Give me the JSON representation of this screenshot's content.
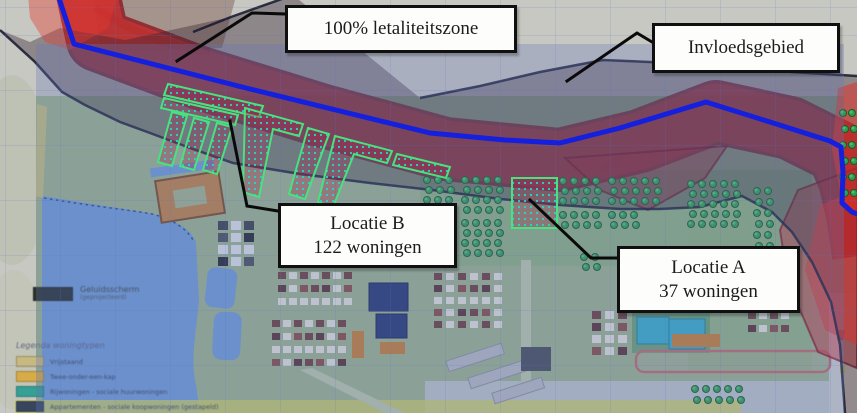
{
  "annotations": {
    "letaliteitszone": "100% letaliteitszone",
    "invloedsgebied": "Invloedsgebied",
    "locatie_b_title": "Locatie B",
    "locatie_b_count": "122 woningen",
    "locatie_a_title": "Locatie A",
    "locatie_a_count": "37 woningen"
  },
  "legend": {
    "barrier_label": "Geluidsscherm",
    "barrier_sublabel": "(geprojecteerd)",
    "barrier_color": "#20261f",
    "title": "Legenda woningtypen",
    "items": [
      {
        "label": "Vrijstaand",
        "color": "#c9b97c"
      },
      {
        "label": "Twee-onder-een-kap",
        "color": "#d9a93c"
      },
      {
        "label": "Rijwoningen - sociale huurwoningen",
        "color": "#2a9d93"
      },
      {
        "label": "Appartementen - sociale koopwoningen (gestapeld)",
        "color": "#2b3a5e"
      },
      {
        "label": "Zorgwoningen - appartementen (gestapeld)",
        "color": "#c2638c"
      }
    ]
  },
  "map_colors": {
    "lethal_zone_fill": "#e23a34",
    "lethal_zone_border": "#8c1420",
    "influence_zone_border": "#15172e",
    "route_line": "#1420dd",
    "location_outline": "#46e37f",
    "overlay_tint": "#6476bc"
  }
}
